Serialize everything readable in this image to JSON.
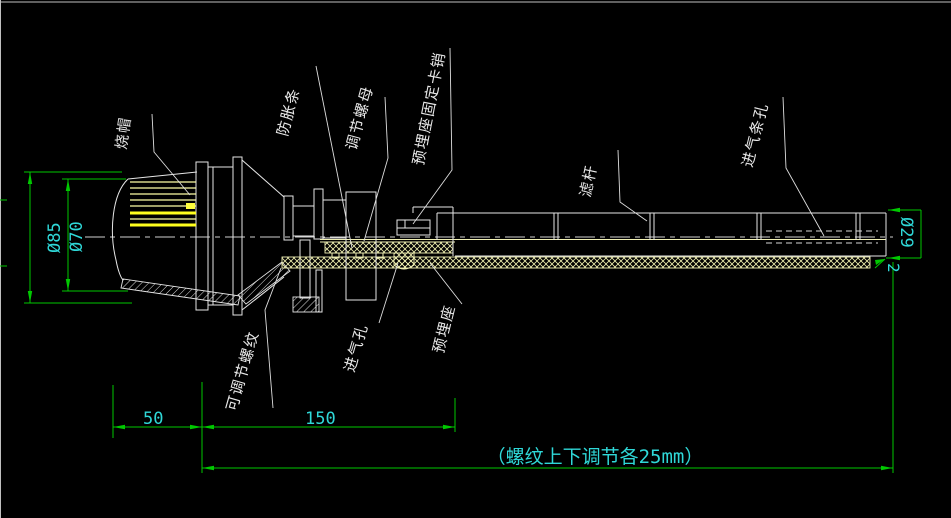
{
  "canvas": {
    "background": "#000000",
    "line_color": "#e6e6e6",
    "dimension_color": "#00c800",
    "dimension_text_color": "#2fd8d8",
    "highlight_color": "#ffff1e"
  },
  "part_labels": [
    {
      "name": "burner-cap",
      "text": "烧帽"
    },
    {
      "name": "anti-expansion-strip",
      "text": "防胀条"
    },
    {
      "name": "adjusting-nut",
      "text": "调节螺母"
    },
    {
      "name": "embedded-seat-fixing-pin",
      "text": "预埋座固定卡销"
    },
    {
      "name": "filter-rod",
      "text": "滤杆"
    },
    {
      "name": "air-inlet-slot-holes",
      "text": "进气条孔"
    },
    {
      "name": "adjustable-thread",
      "text": "可调节螺纹"
    },
    {
      "name": "air-inlet-hole",
      "text": "进气孔"
    },
    {
      "name": "embedded-seat",
      "text": "预埋座"
    }
  ],
  "dimensions": {
    "outer_diameter_left": "Ø85",
    "inner_diameter_left": "Ø70",
    "pipe_diameter_right": "Ø29",
    "wall_thickness": "2",
    "cap_length": "50",
    "body_length": "150",
    "thread_note": "（螺纹上下调节各25mm）"
  }
}
